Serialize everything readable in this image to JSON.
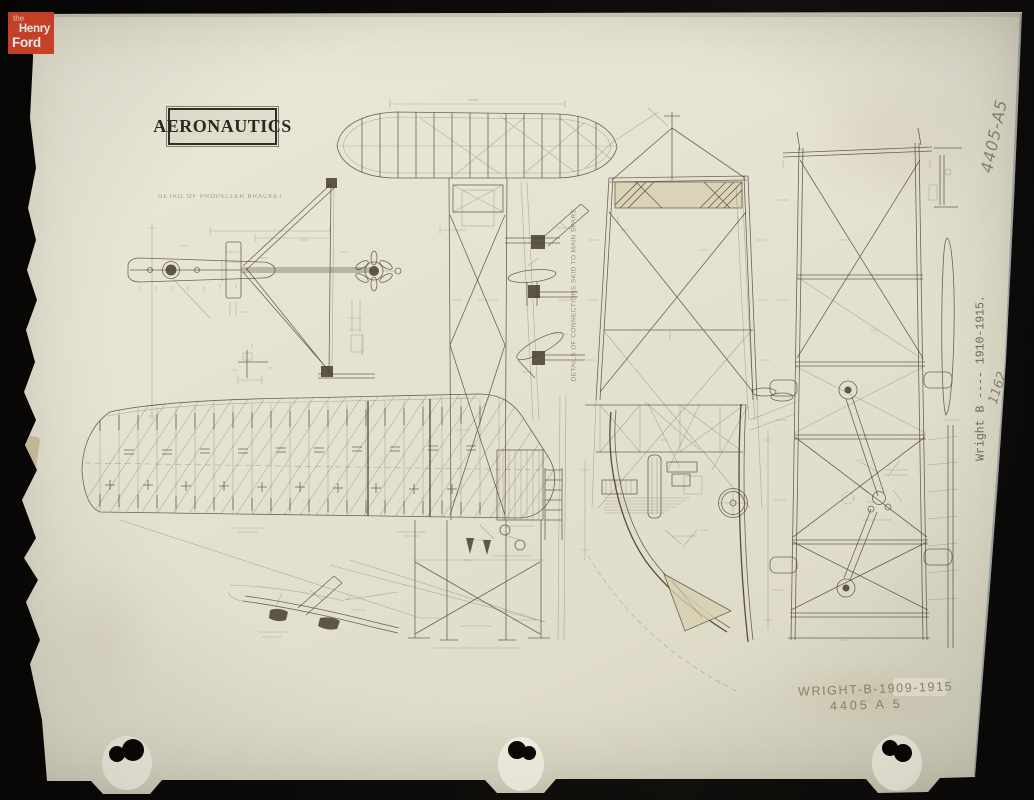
{
  "colors": {
    "background": "#0b0a08",
    "paper": "#e7e3d3",
    "ink": "#4e4536",
    "logo_red": "#d7472c",
    "pencil_gray": "#8b8577",
    "stamp_faded": "#8f8569",
    "edge_blue": "#5d6f85"
  },
  "logo": {
    "line1": "the",
    "line2": "Henry",
    "line3": "Ford"
  },
  "labels": {
    "aeronautics": "AERONAUTICS",
    "connections_note": "DETAILS OF CONNECTIONS SKID TO MAIN SPARS",
    "propeller_note": "DETAIL OF PROPELLER BRACKET"
  },
  "annotations": {
    "catalog_side": "4405-A5",
    "item_label": "Wright B ---- 1910-1915.",
    "accession": "1162",
    "stamp_line1": "WRIGHT-B-1909-1915",
    "stamp_line2": "4405 A 5"
  }
}
